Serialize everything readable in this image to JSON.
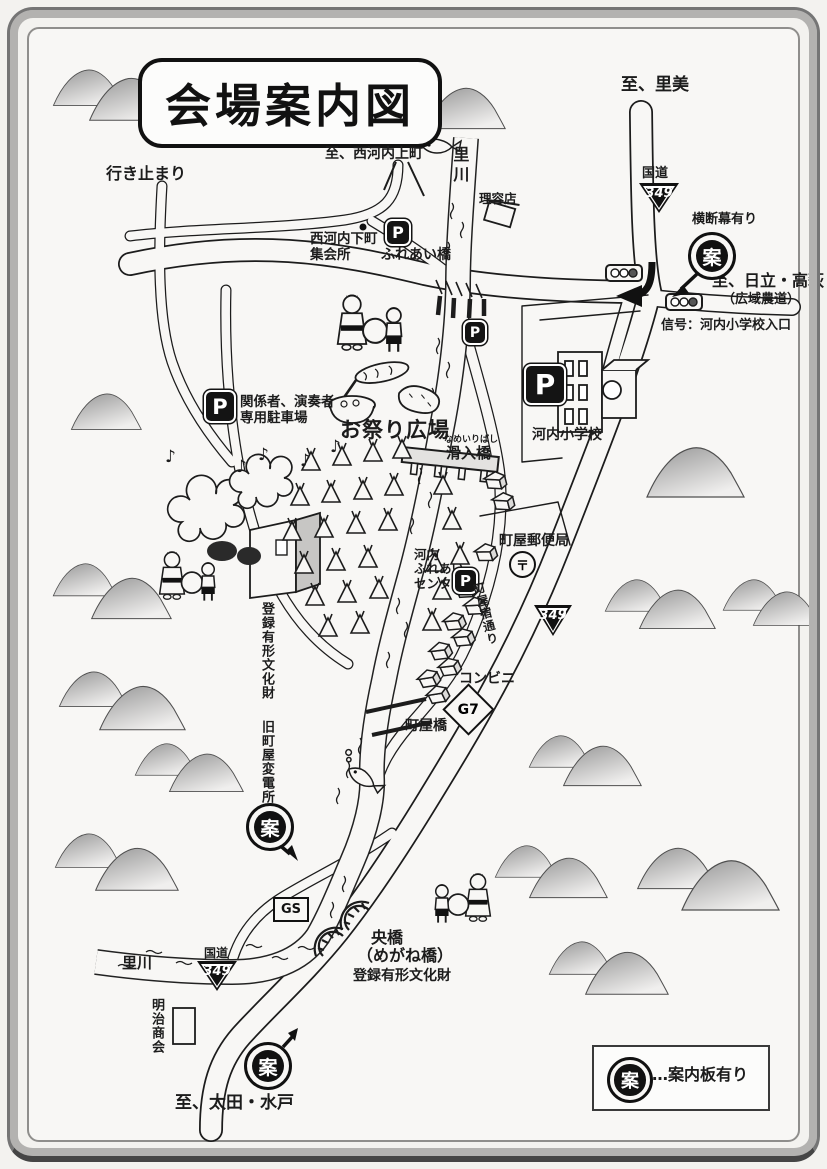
{
  "title": "会場案内図",
  "directions": {
    "north": "至、里美",
    "dead_end": "行き止まり",
    "northwest": "至、西河内上町",
    "east": "至、日立・高萩",
    "east_sub": "（広域農道）",
    "south": "至、太田・水戸"
  },
  "roads": {
    "kokudo": "国道",
    "route_number": "349",
    "signal_note": "信号：河内小学校入口",
    "banner_note": "横断幕有り",
    "machiya_street": "町屋宿通り"
  },
  "river": {
    "name_upper": "里川",
    "name_lower": "里川"
  },
  "badges": {
    "parking": "P",
    "guide": "案",
    "post": "〒",
    "gas": "GS",
    "convenience_name": "G7"
  },
  "places": {
    "barber": "理容店",
    "meeting_hall_1": "西河内下町",
    "meeting_hall_2": "集会所",
    "fureai_bridge": "ふれあい橋",
    "reserved_1": "関係者、演奏者",
    "reserved_2": "専用駐車場",
    "festival_square": "お祭り広場",
    "namerii_furigana": "なめいりばし",
    "namerii_bridge": "滑入橋",
    "school": "河内小学校",
    "post_office": "町屋郵便局",
    "center_1": "河内",
    "center_2": "ふれあい",
    "center_3": "センター",
    "heritage_upper": "登録有形文化財",
    "old_substation": "旧町屋変電所",
    "convenience": "コンビニ",
    "machiya_bridge": "町屋橋",
    "ohashi": "央橋",
    "ohashi_alias": "（めがね橋）",
    "heritage_lower": "登録有形文化財",
    "meiji_shokai": "明治商会"
  },
  "legend": {
    "text": "…案内板有り"
  },
  "icons": {
    "music_note": "♪"
  },
  "colors": {
    "ink": "#1c1c1c",
    "paper": "#f8f7f5",
    "mountain_dark": "#9a9a9a",
    "mountain_light": "#efeeec",
    "frame": "#a9a9a9"
  }
}
